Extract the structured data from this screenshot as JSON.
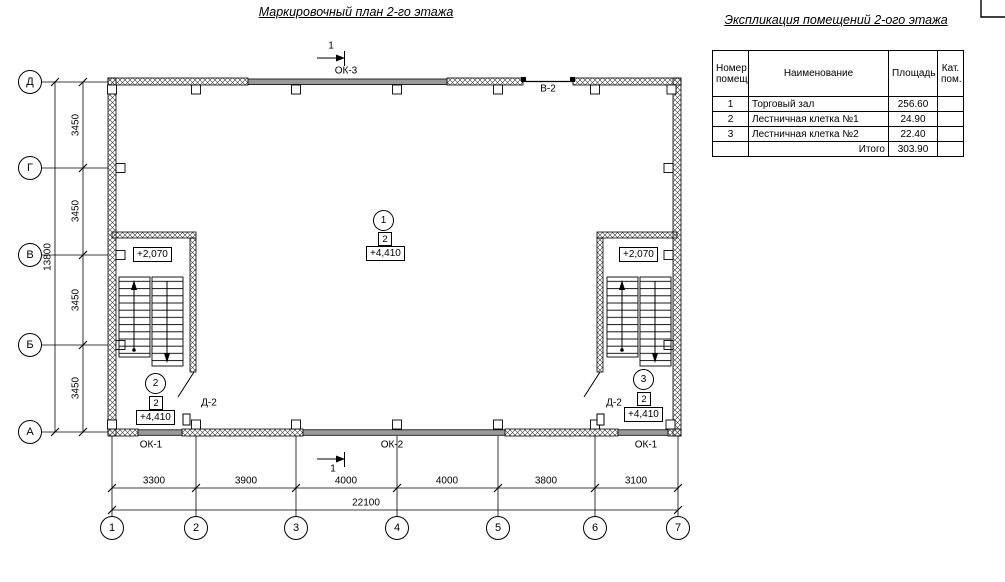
{
  "titles": {
    "plan": "Маркировочный план 2-го этажа",
    "table": "Экспликация помещений 2-ого этажа"
  },
  "section_mark": {
    "label": "1"
  },
  "axes": {
    "rows": [
      "Д",
      "Г",
      "В",
      "Б",
      "А"
    ],
    "cols": [
      "1",
      "2",
      "3",
      "4",
      "5",
      "6",
      "7"
    ]
  },
  "dims": {
    "row_bays": [
      "3450",
      "3450",
      "3450",
      "3450"
    ],
    "row_total": "13800",
    "col_bays": [
      "3300",
      "3900",
      "4000",
      "4000",
      "3800",
      "3100"
    ],
    "col_total": "22100"
  },
  "openings": {
    "ok3": "ОК-3",
    "v2": "В-2",
    "ok1_left": "ОК-1",
    "ok2": "ОК-2",
    "ok1_right": "ОК-1",
    "door_left": "Д-2",
    "door_right": "Д-2"
  },
  "markers": {
    "hall": {
      "num": "1",
      "cat": "2",
      "elev": "+4,410"
    },
    "stair_left": {
      "num": "2",
      "cat": "2",
      "elev": "+4,410",
      "landing_elev": "+2,070"
    },
    "stair_right": {
      "num": "3",
      "cat": "2",
      "elev": "+4,410",
      "landing_elev": "+2,070"
    }
  },
  "table": {
    "headers": [
      "Номер помещ.",
      "Наименование",
      "Площадь",
      "Кат. пом."
    ],
    "rows": [
      [
        "1",
        "Торговый зал",
        "256.60",
        ""
      ],
      [
        "2",
        "Лестничная клетка №1",
        "24.90",
        ""
      ],
      [
        "3",
        "Лестничная клетка №2",
        "22.40",
        ""
      ]
    ],
    "total_label": "Итого",
    "total_value": "303.90"
  }
}
